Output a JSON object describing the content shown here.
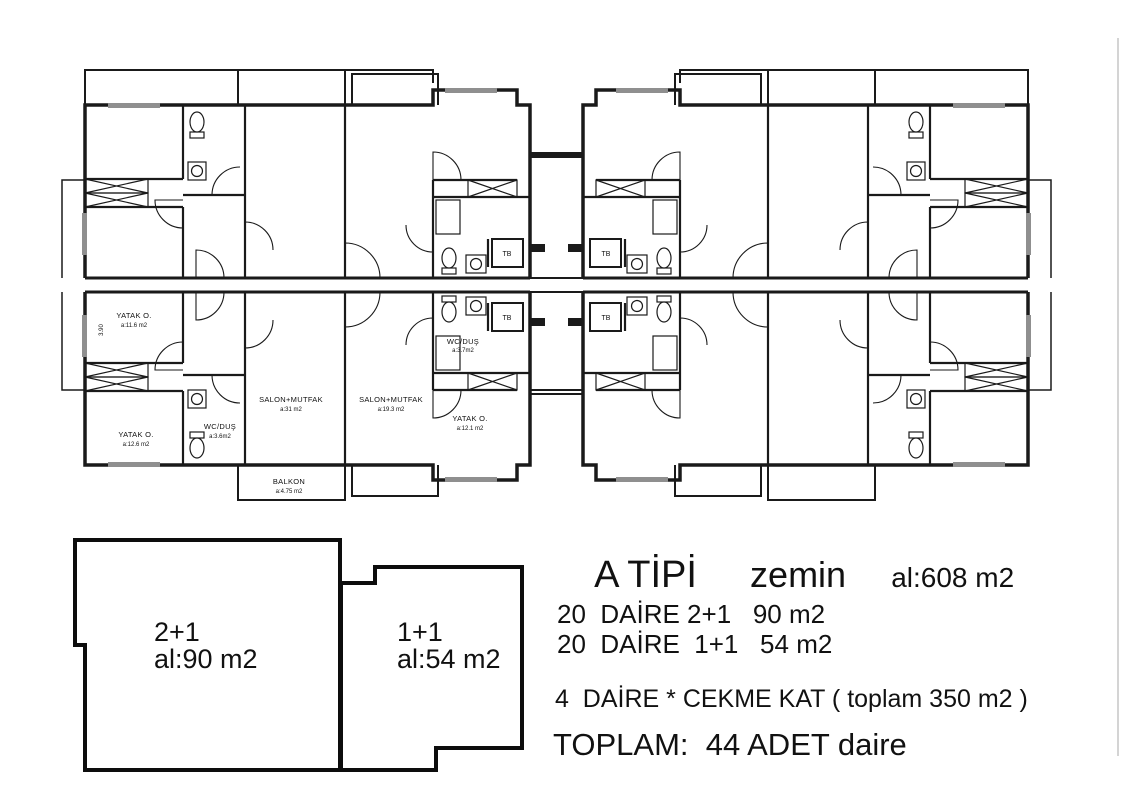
{
  "plan": {
    "rooms": [
      {
        "name": "YATAK O.",
        "area": "a:11.6 m2"
      },
      {
        "name": "YATAK O.",
        "area": "a:12.6 m2"
      },
      {
        "name": "WC/DUŞ",
        "area": "a:3.6m2"
      },
      {
        "name": "SALON+MUTFAK",
        "area": "a:31 m2"
      },
      {
        "name": "SALON+MUTFAK",
        "area": "a:19.3 m2"
      },
      {
        "name": "YATAK O.",
        "area": "a:12.1 m2"
      },
      {
        "name": "WC/DUŞ",
        "area": "a:3.7m2"
      },
      {
        "name": "BALKON",
        "area": "a:4.75 m2"
      }
    ],
    "tb_label": "TB",
    "dimension_left": "3.90"
  },
  "key_units": {
    "left": {
      "type": "2+1",
      "area": "al:90 m2"
    },
    "right": {
      "type": "1+1",
      "area": "al:54 m2"
    }
  },
  "summary": {
    "title": "A TİPİ",
    "floor": "zemin",
    "area": "al:608 m2",
    "lines": [
      "20  DAİRE 2+1   90 m2",
      "20  DAİRE  1+1   54 m2",
      "4  DAİRE * CEKME KAT ( toplam 350 m2 )",
      "TOPLAM:  44 ADET daire"
    ]
  },
  "colors": {
    "wall": "#1a1a1a",
    "window": "#8f8f8f",
    "background": "#ffffff"
  }
}
